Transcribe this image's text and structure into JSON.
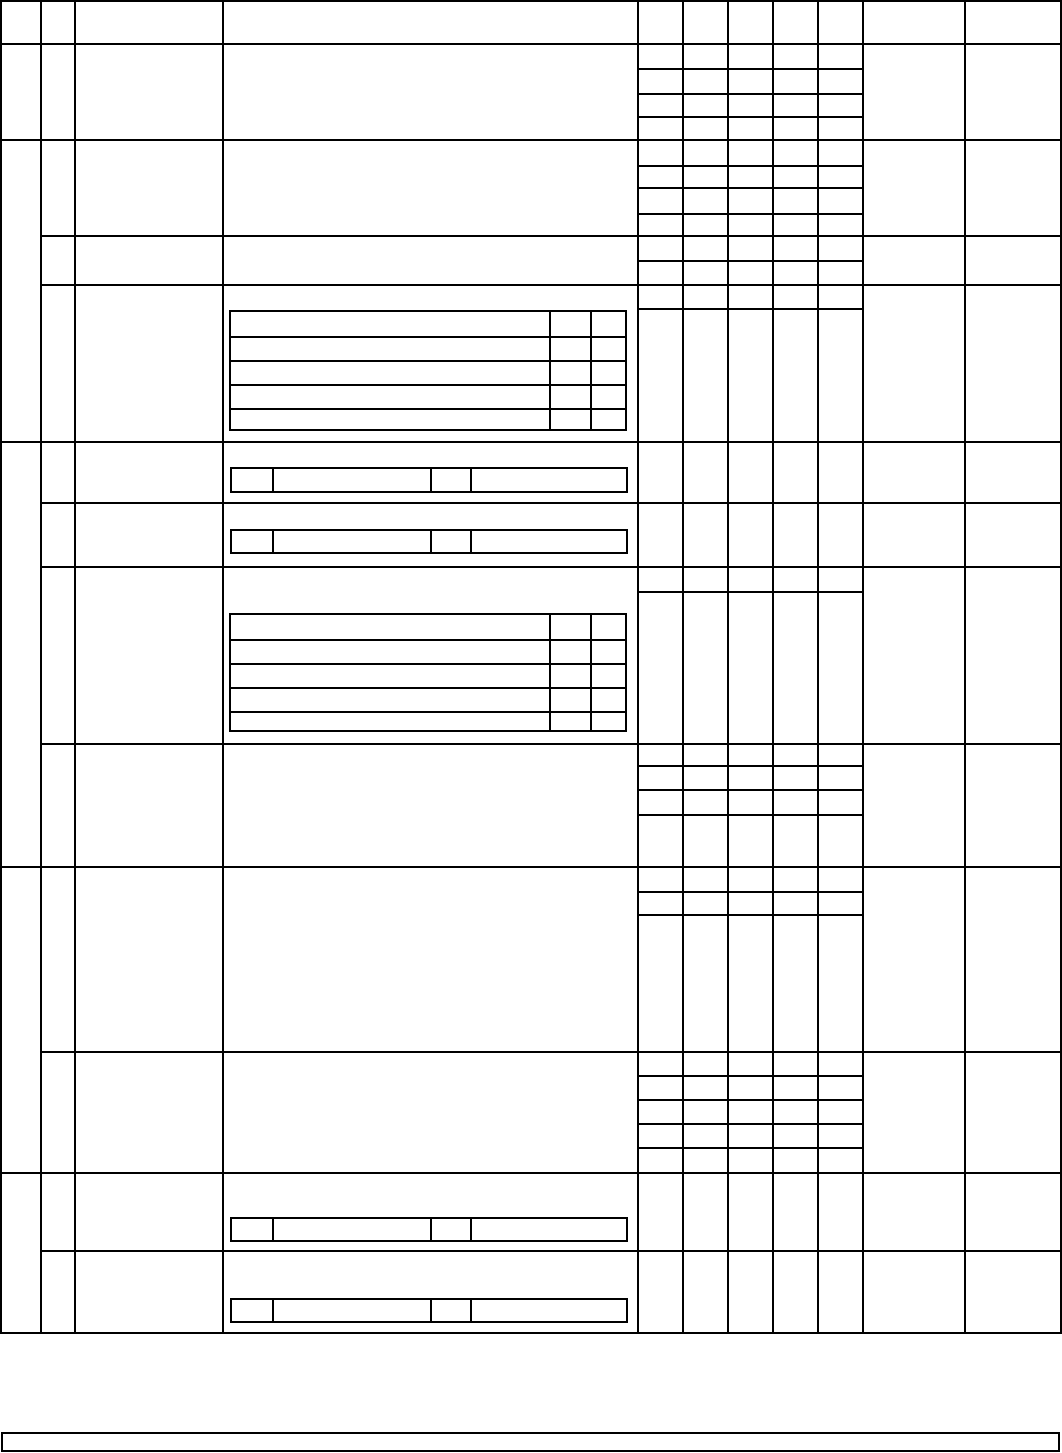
{
  "theme": {
    "paper": "#ffffff",
    "line": "#000000"
  }
}
